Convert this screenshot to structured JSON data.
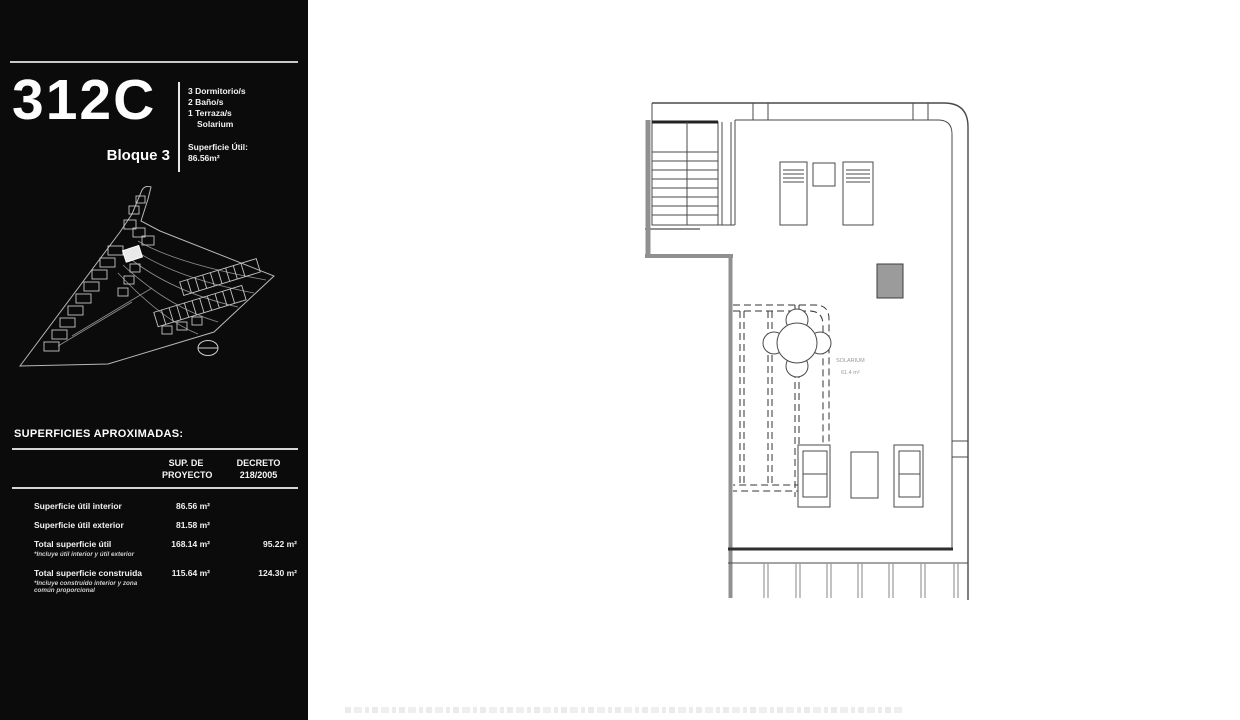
{
  "unit": {
    "code": "312C",
    "block": "Bloque 3",
    "features": [
      "3 Dormitorio/s",
      "2 Baño/s",
      "1 Terraza/s",
      "Solarium"
    ],
    "usable_area_label": "Superficie Útil:",
    "usable_area_value": "86.56m²"
  },
  "areas_table": {
    "title": "SUPERFICIES APROXIMADAS:",
    "col1_line1": "SUP. DE",
    "col1_line2": "PROYECTO",
    "col2_line1": "DECRETO",
    "col2_line2": "218/2005",
    "rows": [
      {
        "label": "Superficie útil interior",
        "footnote": "",
        "sup_proyecto": "86.56 m²",
        "decreto": ""
      },
      {
        "label": "Superficie útil exterior",
        "footnote": "",
        "sup_proyecto": "81.58 m²",
        "decreto": ""
      },
      {
        "label": "Total superficie útil",
        "footnote": "*Incluye útil interior y útil exterior",
        "sup_proyecto": "168.14 m²",
        "decreto": "95.22 m²"
      },
      {
        "label": "Total superficie construida",
        "footnote": "*Incluye construido interior y zona común proporcional",
        "sup_proyecto": "115.64 m²",
        "decreto": "124.30 m²"
      }
    ]
  },
  "floor_plan": {
    "room_label": "SOLARIUM",
    "room_area": "61.4 m²"
  },
  "colors": {
    "panel_background": "#0b0b0b",
    "panel_text": "#f2f2f2",
    "plan_line": "#4a4a4a",
    "plan_wall_gray": "#909090",
    "plan_block_fill": "#9b9b9b"
  }
}
